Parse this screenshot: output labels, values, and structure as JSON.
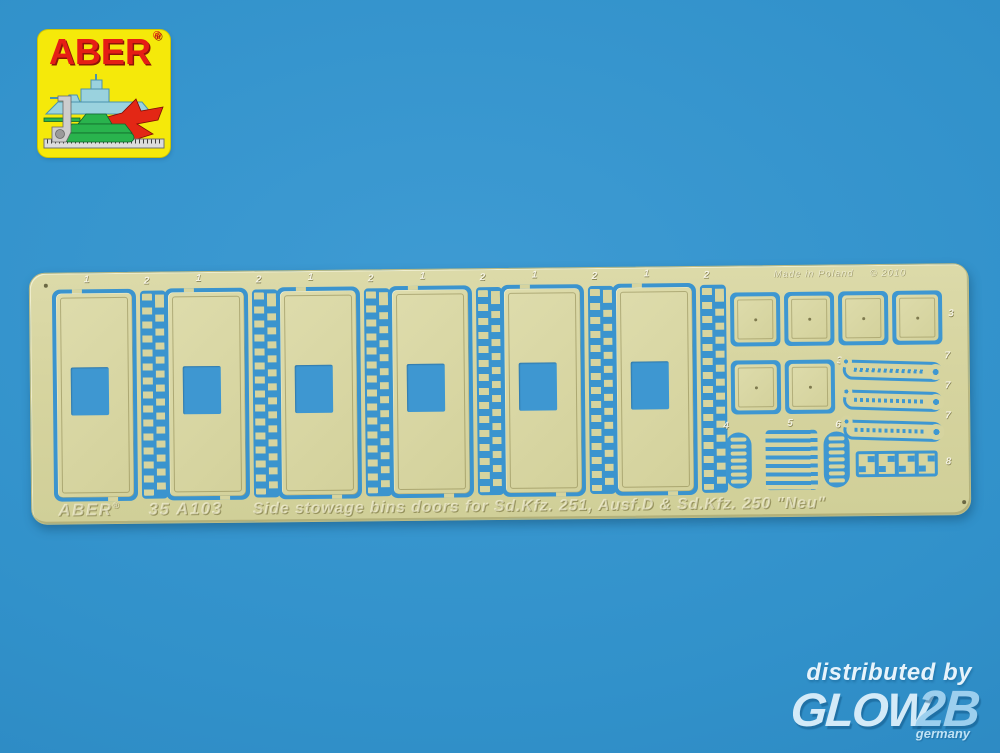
{
  "colors": {
    "background_blue": "#3191CA",
    "fret_brass": "#D6D49F",
    "etched_slot_blue": "#3B94CE",
    "logo_yellow": "#F5E90A",
    "logo_red": "#E51E15",
    "distributor_text": "#D3EAF8"
  },
  "logo": {
    "brand": "ABER",
    "registered": "®",
    "icons": [
      "battleship-icon",
      "fighter-jet-icon",
      "tank-icon",
      "machinist-square-icon",
      "ruler-icon"
    ]
  },
  "fret": {
    "made_in_text": "Made in Poland",
    "copyright_text": "© 2010",
    "etched_brand": "ABER",
    "etched_reg": "®",
    "etched_code": "35 A103",
    "etched_desc": "Side stowage bins doors for Sd.Kfz. 251, Ausf.D & Sd.Kfz. 250 \"Neu\"",
    "part_labels": {
      "door": "1",
      "hinge_strip": "2",
      "small_door": "3",
      "link_cluster_a": "4",
      "latch_bars": "5",
      "link_cluster_b": "6",
      "long_hinge": "7",
      "brackets": "8"
    }
  },
  "distributor": {
    "tagline": "distributed by",
    "brand_main": "GLOW",
    "brand_suffix": "2B",
    "country": "germany"
  }
}
